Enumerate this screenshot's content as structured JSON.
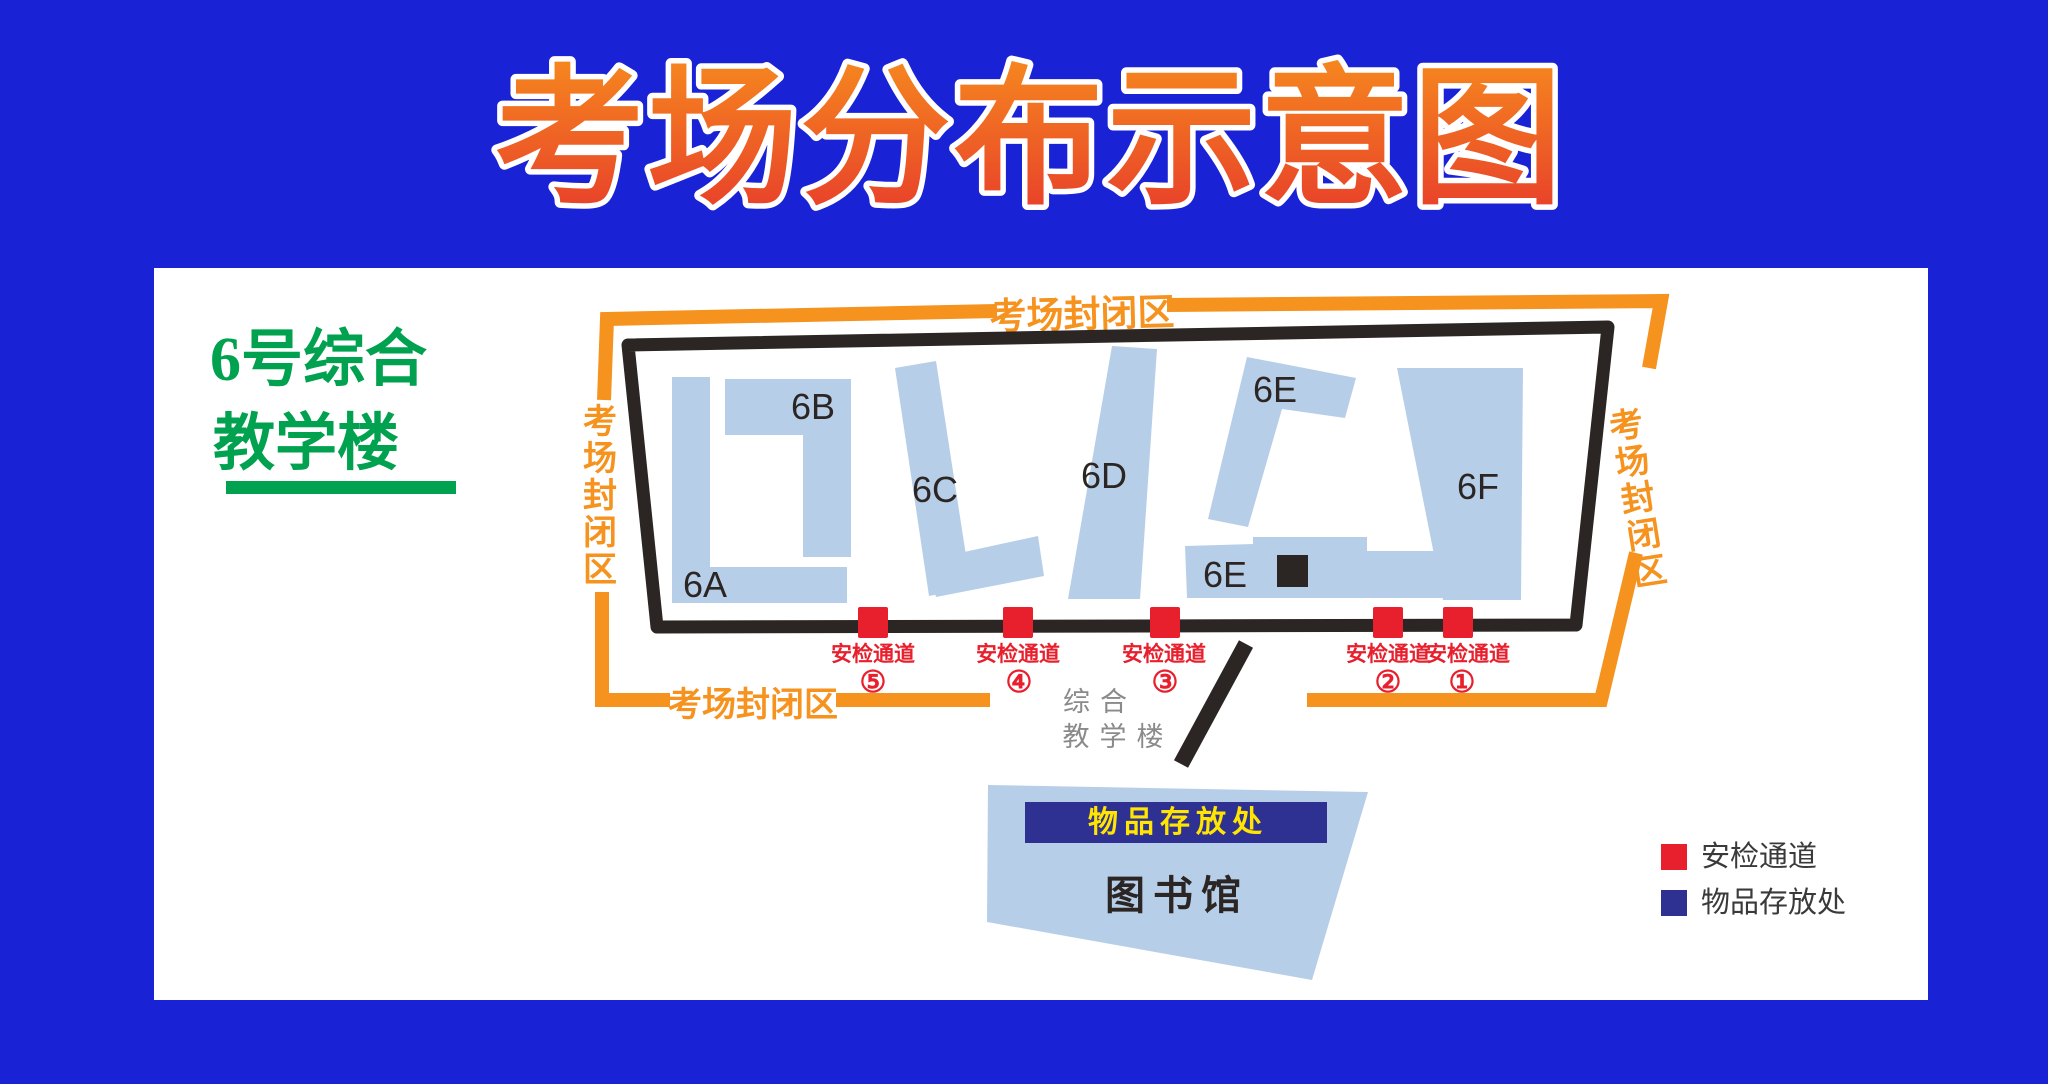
{
  "title": "考场分布示意图",
  "heading": {
    "line1": "6号综合",
    "line2": "教学楼"
  },
  "map": {
    "closed_area_label": "考场封闭区",
    "buildings": {
      "a": "6A",
      "b": "6B",
      "c": "6C",
      "d": "6D",
      "e_upper": "6E",
      "e_lower": "6E",
      "f": "6F"
    },
    "gate_label": "安检通道",
    "gate_numbers": [
      "⑤",
      "④",
      "③",
      "②",
      "①"
    ],
    "caption_line1": "综合",
    "caption_line2": "教学楼",
    "library_name": "图书馆",
    "storage_banner": "物品存放处"
  },
  "legend": {
    "items": [
      {
        "label": "安检通道",
        "color": "#e8202d"
      },
      {
        "label": "物品存放处",
        "color": "#2e3192"
      }
    ]
  },
  "colors": {
    "background_blue": "#1a22d5",
    "panel_white": "#ffffff",
    "closed_area_orange": "#f6921e",
    "building_fill_blue": "#b7cee8",
    "outline_black": "#2b2523",
    "gate_red": "#e8202d",
    "storage_navy": "#2e3192",
    "banner_text_yellow": "#ffe500",
    "heading_green": "#00a14f",
    "title_gradient_top": "#f6891e",
    "title_gradient_bottom": "#e73c2b"
  }
}
